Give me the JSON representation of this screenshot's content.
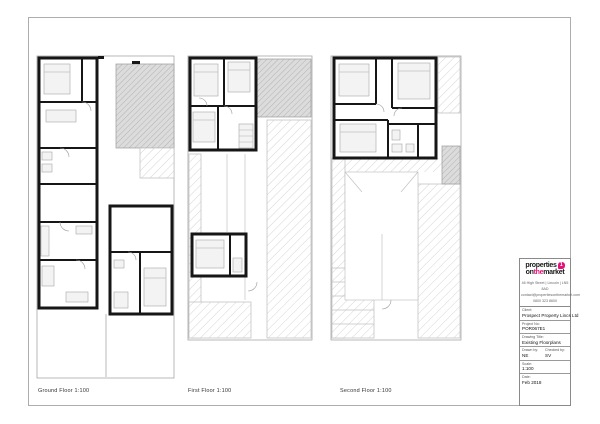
{
  "sheet": {
    "plans": [
      {
        "name": "ground-floor",
        "label": "Ground Floor 1:100"
      },
      {
        "name": "first-floor",
        "label": "First Floor 1:100"
      },
      {
        "name": "second-floor",
        "label": "Second Floor 1:100"
      }
    ],
    "title_block": {
      "brand": {
        "word1": "properties",
        "word2a": "on",
        "word2b": "the",
        "word2c": "market",
        "icon_text": "1",
        "accent_color": "#e4117b"
      },
      "contact": {
        "address": "46 High Street | Lincoln | LN5 8AD",
        "email": "contact@propertiesonthemarket.com",
        "phone": "0800 323 8600"
      },
      "fields": {
        "client": {
          "label": "Client:",
          "value": "Prospect Property Lincs Ltd"
        },
        "project_no": {
          "label": "Project No:",
          "value": "POR067E1"
        },
        "drawing_title": {
          "label": "Drawing Title:",
          "value": "Existing Floorplans"
        },
        "drawn_by": {
          "label": "Drawn by:",
          "value": "NE"
        },
        "checked_by": {
          "label": "Checked by:",
          "value": "SV"
        },
        "scale": {
          "label": "Scale:",
          "value": "1:100"
        },
        "date": {
          "label": "Date:",
          "value": "Feb 2018"
        }
      }
    }
  }
}
